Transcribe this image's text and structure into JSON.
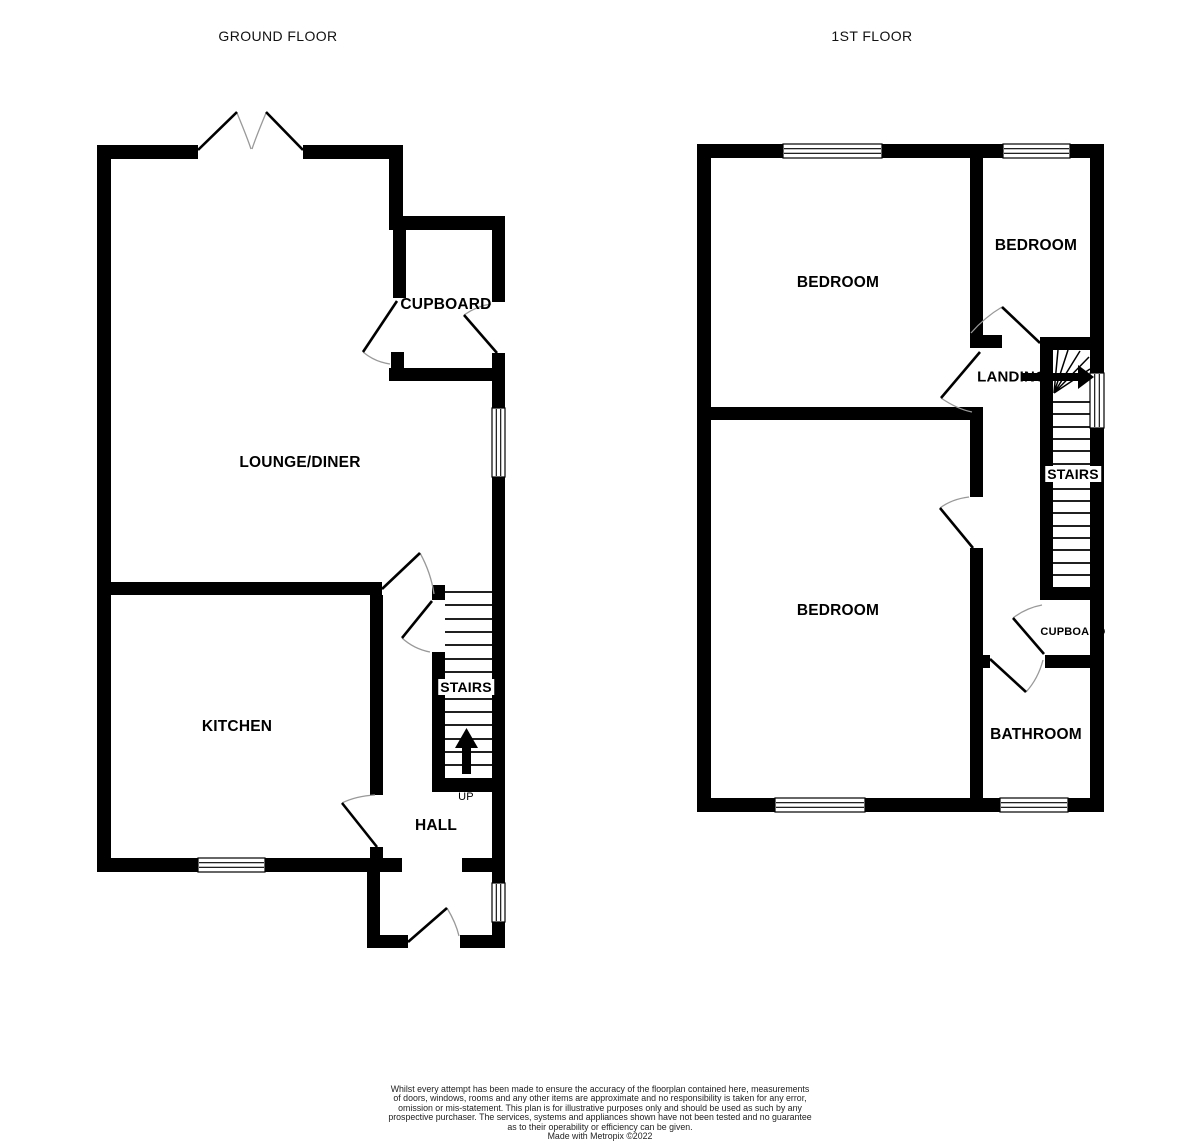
{
  "ground_floor": {
    "title": "GROUND FLOOR",
    "rooms": {
      "lounge_diner": "LOUNGE/DINER",
      "cupboard": "CUPBOARD",
      "kitchen": "KITCHEN",
      "stairs": "STAIRS",
      "up": "UP",
      "hall": "HALL"
    }
  },
  "first_floor": {
    "title": "1ST FLOOR",
    "rooms": {
      "bedroom_front": "BEDROOM",
      "bedroom_small": "BEDROOM",
      "landing": "LANDING",
      "stairs": "STAIRS",
      "bedroom_back": "BEDROOM",
      "cupboard": "CUPBOARD",
      "bathroom": "BATHROOM"
    }
  },
  "footer": {
    "disclaimer_lines": [
      "Whilst every attempt has been made to ensure the accuracy of the floorplan contained here, measurements",
      "of doors, windows, rooms and any other items are approximate and no responsibility is taken for any error,",
      "omission or mis-statement. This plan is for illustrative purposes only and should be used as such by any",
      "prospective purchaser. The services, systems and appliances shown have not been tested and no guarantee",
      "as to their operability or efficiency can be given."
    ],
    "credit": "Made with Metropix ©2022"
  },
  "colors": {
    "wall": "#000000",
    "background": "#ffffff",
    "door_swing": "#999999"
  }
}
